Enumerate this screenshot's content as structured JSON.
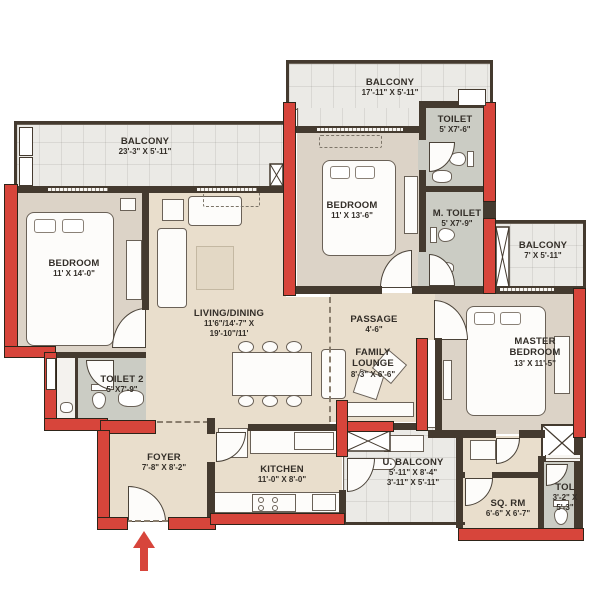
{
  "meta": {
    "type": "apartment-floor-plan"
  },
  "colors": {
    "wall_red": "#d7453b",
    "wall_dark": "#443a2f",
    "floor_beige": "#e9decc",
    "floor_bedroom": "#dcd3c7",
    "floor_tile": "#ebeae6",
    "floor_toilet": "#cbccc4",
    "label_text": "#332e28"
  },
  "rooms": [
    {
      "id": "balcony-top-left",
      "name": "BALCONY",
      "dims": "23'-3\" X 5'-11\""
    },
    {
      "id": "balcony-top-mid",
      "name": "BALCONY",
      "dims": "17'-11\" X 5'-11\""
    },
    {
      "id": "toilet-top",
      "name": "TOILET",
      "dims": "5' X7'-6\""
    },
    {
      "id": "bedroom-left",
      "name": "BEDROOM",
      "dims": "11' X 14'-0\""
    },
    {
      "id": "bedroom-mid",
      "name": "BEDROOM",
      "dims": "11' X 13'-6\""
    },
    {
      "id": "m-toilet",
      "name": "M. TOILET",
      "dims": "5' X7'-9\""
    },
    {
      "id": "balcony-right",
      "name": "BALCONY",
      "dims": "7' X 5'-11\""
    },
    {
      "id": "living-dining",
      "name": "LIVING/DINING",
      "dims": "11'6\"/14'-7\" X",
      "dims2": "19'-10\"/11'"
    },
    {
      "id": "passage",
      "name": "PASSAGE",
      "dims": "4'-6\""
    },
    {
      "id": "master-bedroom",
      "name": "MASTER BEDROOM",
      "dims": "13' X 11'-5\""
    },
    {
      "id": "family-lounge",
      "name": "FAMILY LOUNGE",
      "dims": "8'-3\" X 6'-6\""
    },
    {
      "id": "toilet-2",
      "name": "TOILET 2",
      "dims": "5' X7'-9\""
    },
    {
      "id": "foyer",
      "name": "FOYER",
      "dims": "7'-8\" X 8'-2\""
    },
    {
      "id": "kitchen",
      "name": "KITCHEN",
      "dims": "11'-0\" X 8'-0\""
    },
    {
      "id": "u-balcony",
      "name": "U. BALCONY",
      "dims": "5'-11\" X 8'-4\"",
      "dims2": "3'-11\" X 5'-11\""
    },
    {
      "id": "sq-rm",
      "name": "SQ. RM",
      "dims": "6'-6\" X 6'-7\""
    },
    {
      "id": "tol",
      "name": "TOL",
      "dims": "3'-2\" X",
      "dims2": "5'-3\""
    }
  ],
  "entrance": {
    "symbol": "entry-arrow",
    "color": "#d7453b"
  }
}
